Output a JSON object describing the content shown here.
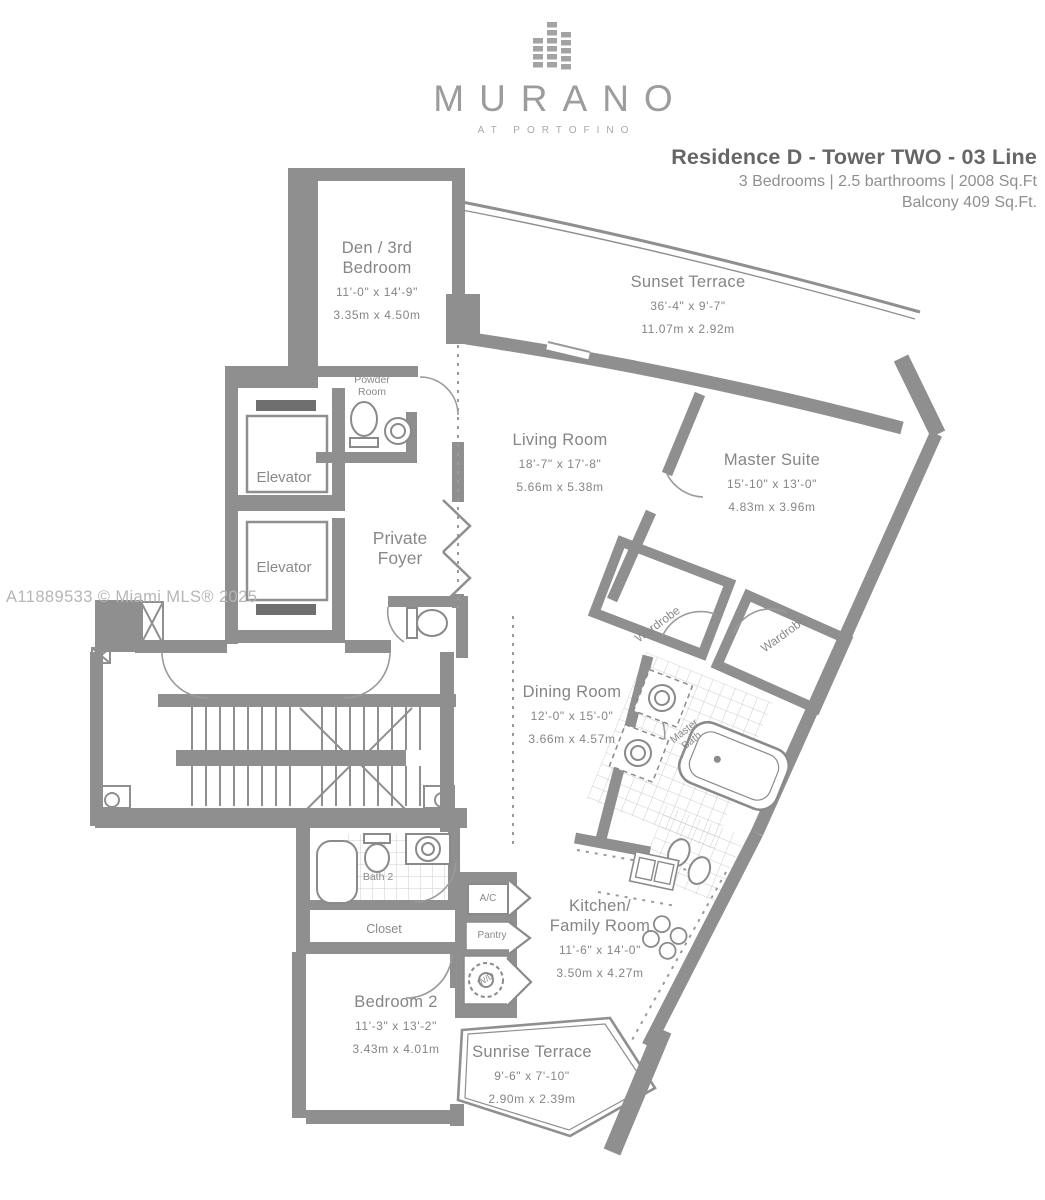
{
  "header": {
    "logo_text": "MURANO",
    "logo_subtext": "AT PORTOFINO",
    "title": "Residence D - Tower TWO - 03 Line",
    "subtitle_line1": "3 Bedrooms | 2.5 barthrooms | 2008 Sq.Ft",
    "subtitle_line2": "Balcony 409 Sq.Ft."
  },
  "watermark": "A11889533 © Miami MLS® 2025",
  "rooms": [
    {
      "name": "Den / 3rd\nBedroom",
      "dims_ft": "11'-0\" x 14'-9\"",
      "dims_m": "3.35m x 4.50m"
    },
    {
      "name": "Sunset Terrace",
      "dims_ft": "36'-4\" x 9'-7\"",
      "dims_m": "11.07m x 2.92m"
    },
    {
      "name": "Living Room",
      "dims_ft": "18'-7\" x 17'-8\"",
      "dims_m": "5.66m x 5.38m"
    },
    {
      "name": "Master Suite",
      "dims_ft": "15'-10\" x 13'-0\"",
      "dims_m": "4.83m x 3.96m"
    },
    {
      "name": "Dining Room",
      "dims_ft": "12'-0\" x 15'-0\"",
      "dims_m": "3.66m x 4.57m"
    },
    {
      "name": "Kitchen/\nFamily Room",
      "dims_ft": "11'-6\" x 14'-0\"",
      "dims_m": "3.50m x 4.27m"
    },
    {
      "name": "Bedroom 2",
      "dims_ft": "11'-3\" x 13'-2\"",
      "dims_m": "3.43m x 4.01m"
    },
    {
      "name": "Sunrise Terrace",
      "dims_ft": "9'-6\" x 7'-10\"",
      "dims_m": "2.90m x 2.39m"
    }
  ],
  "labels": {
    "powder_room": "Powder Room",
    "elevator_1": "Elevator",
    "elevator_2": "Elevator",
    "private_foyer": "Private Foyer",
    "wardrobe_1": "Wardrobe",
    "wardrobe_2": "Wardrobe",
    "master_bath": "Master Bath",
    "bath_2": "Bath 2",
    "closet": "Closet",
    "ac": "A/C",
    "pantry": "Pantry",
    "wd": "W/D"
  },
  "colors": {
    "wall": "#8f8f8f",
    "fixture_line": "#8a8a8a",
    "tile_line": "#c9c9c9",
    "label_text": "#858585",
    "title_text": "#666666",
    "watermark": "#b6b6b6",
    "logo": "#9c9c9c"
  }
}
